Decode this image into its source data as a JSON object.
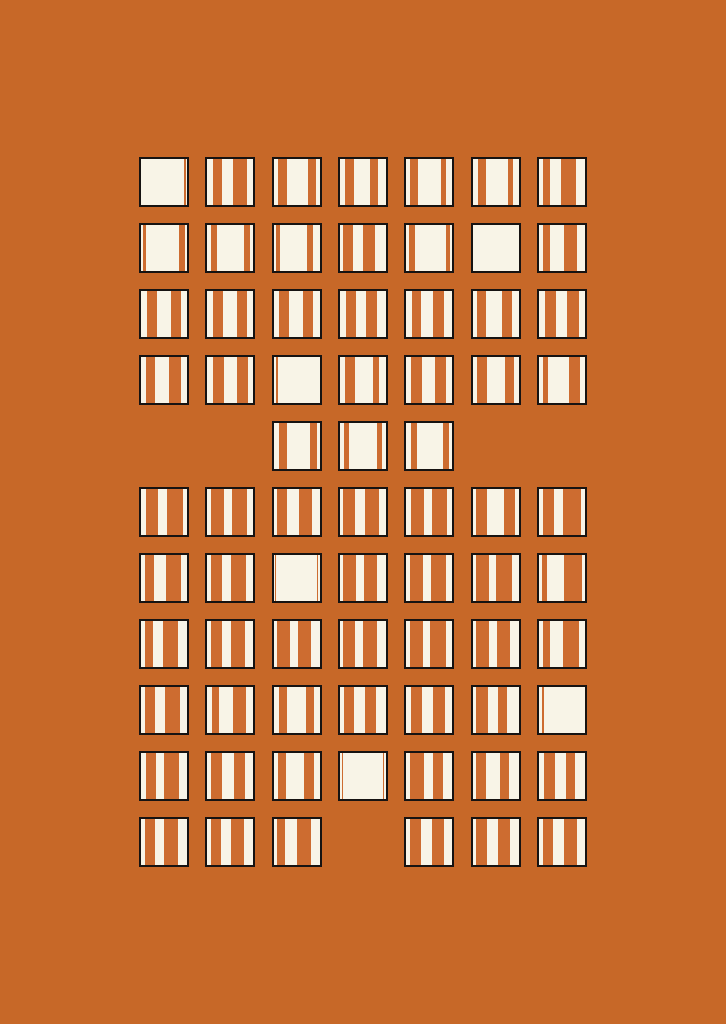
{
  "artwork": {
    "title": "striped-squares-grid-poster",
    "colors": {
      "background": "#C76828",
      "square_fill": "#F8F4E7",
      "stripe": "#CD6C30",
      "border": "#161312"
    },
    "grid": {
      "cols": 7,
      "rows": 11,
      "origin_x": 139,
      "origin_y": 157,
      "pitch_x": 66.33,
      "pitch_y": 66,
      "cell_size": 50,
      "border_px": 2
    },
    "missing_cells_note": "row 4 (0-based) only has cols 2-4; row 10 is missing col 3",
    "cells": [
      {
        "row": 0,
        "col": 0,
        "stripes": [
          [
            93,
            4
          ]
        ]
      },
      {
        "row": 0,
        "col": 1,
        "stripes": [
          [
            13,
            20
          ],
          [
            56,
            30
          ]
        ]
      },
      {
        "row": 0,
        "col": 2,
        "stripes": [
          [
            10,
            20
          ],
          [
            75,
            17
          ]
        ]
      },
      {
        "row": 0,
        "col": 3,
        "stripes": [
          [
            10,
            21
          ],
          [
            66,
            17
          ]
        ]
      },
      {
        "row": 0,
        "col": 4,
        "stripes": [
          [
            8,
            18
          ],
          [
            76,
            10
          ]
        ]
      },
      {
        "row": 0,
        "col": 5,
        "stripes": [
          [
            11,
            18
          ],
          [
            77,
            10
          ]
        ]
      },
      {
        "row": 0,
        "col": 6,
        "stripes": [
          [
            8,
            17
          ],
          [
            48,
            33
          ]
        ]
      },
      {
        "row": 1,
        "col": 0,
        "stripes": [
          [
            4,
            7
          ],
          [
            83,
            12
          ]
        ]
      },
      {
        "row": 1,
        "col": 1,
        "stripes": [
          [
            8,
            13
          ],
          [
            79,
            13
          ]
        ]
      },
      {
        "row": 1,
        "col": 2,
        "stripes": [
          [
            6,
            8
          ],
          [
            72,
            13
          ]
        ]
      },
      {
        "row": 1,
        "col": 3,
        "stripes": [
          [
            6,
            22
          ],
          [
            50,
            26
          ]
        ]
      },
      {
        "row": 1,
        "col": 4,
        "stripes": [
          [
            6,
            12
          ],
          [
            87,
            7
          ]
        ]
      },
      {
        "row": 1,
        "col": 5,
        "stripes": []
      },
      {
        "row": 1,
        "col": 6,
        "stripes": [
          [
            8,
            15
          ],
          [
            54,
            28
          ]
        ]
      },
      {
        "row": 2,
        "col": 0,
        "stripes": [
          [
            14,
            21
          ],
          [
            66,
            22
          ]
        ]
      },
      {
        "row": 2,
        "col": 1,
        "stripes": [
          [
            13,
            22
          ],
          [
            64,
            23
          ]
        ]
      },
      {
        "row": 2,
        "col": 2,
        "stripes": [
          [
            11,
            23
          ],
          [
            63,
            22
          ]
        ]
      },
      {
        "row": 2,
        "col": 3,
        "stripes": [
          [
            12,
            22
          ],
          [
            56,
            24
          ]
        ]
      },
      {
        "row": 2,
        "col": 4,
        "stripes": [
          [
            12,
            20
          ],
          [
            58,
            24
          ]
        ]
      },
      {
        "row": 2,
        "col": 5,
        "stripes": [
          [
            10,
            20
          ],
          [
            64,
            22
          ]
        ]
      },
      {
        "row": 2,
        "col": 6,
        "stripes": [
          [
            14,
            22
          ],
          [
            60,
            26
          ]
        ]
      },
      {
        "row": 3,
        "col": 0,
        "stripes": [
          [
            10,
            20
          ],
          [
            60,
            26
          ]
        ]
      },
      {
        "row": 3,
        "col": 1,
        "stripes": [
          [
            12,
            24
          ],
          [
            64,
            24
          ]
        ]
      },
      {
        "row": 3,
        "col": 2,
        "stripes": [
          [
            5,
            4
          ]
        ]
      },
      {
        "row": 3,
        "col": 3,
        "stripes": [
          [
            10,
            22
          ],
          [
            72,
            12
          ]
        ]
      },
      {
        "row": 3,
        "col": 4,
        "stripes": [
          [
            10,
            24
          ],
          [
            62,
            24
          ]
        ]
      },
      {
        "row": 3,
        "col": 5,
        "stripes": [
          [
            10,
            22
          ],
          [
            71,
            19
          ]
        ]
      },
      {
        "row": 3,
        "col": 6,
        "stripes": [
          [
            9,
            10
          ],
          [
            66,
            24
          ]
        ]
      },
      {
        "row": 4,
        "col": 2,
        "stripes": [
          [
            11,
            19
          ],
          [
            78,
            16
          ]
        ]
      },
      {
        "row": 4,
        "col": 3,
        "stripes": [
          [
            8,
            12
          ],
          [
            80,
            11
          ]
        ]
      },
      {
        "row": 4,
        "col": 4,
        "stripes": [
          [
            11,
            13
          ],
          [
            79,
            14
          ]
        ]
      },
      {
        "row": 5,
        "col": 0,
        "stripes": [
          [
            10,
            28
          ],
          [
            56,
            36
          ]
        ]
      },
      {
        "row": 5,
        "col": 1,
        "stripes": [
          [
            9,
            28
          ],
          [
            54,
            33
          ]
        ]
      },
      {
        "row": 5,
        "col": 2,
        "stripes": [
          [
            7,
            22
          ],
          [
            55,
            28
          ]
        ]
      },
      {
        "row": 5,
        "col": 3,
        "stripes": [
          [
            7,
            25
          ],
          [
            55,
            30
          ]
        ]
      },
      {
        "row": 5,
        "col": 4,
        "stripes": [
          [
            10,
            28
          ],
          [
            56,
            32
          ]
        ]
      },
      {
        "row": 5,
        "col": 5,
        "stripes": [
          [
            7,
            25
          ],
          [
            68,
            25
          ]
        ]
      },
      {
        "row": 5,
        "col": 6,
        "stripes": [
          [
            8,
            24
          ],
          [
            52,
            40
          ]
        ]
      },
      {
        "row": 6,
        "col": 0,
        "stripes": [
          [
            8,
            20
          ],
          [
            54,
            34
          ]
        ]
      },
      {
        "row": 6,
        "col": 1,
        "stripes": [
          [
            8,
            24
          ],
          [
            52,
            33
          ]
        ]
      },
      {
        "row": 6,
        "col": 2,
        "stripes": [
          [
            3,
            3
          ],
          [
            94,
            3
          ]
        ]
      },
      {
        "row": 6,
        "col": 3,
        "stripes": [
          [
            6,
            28
          ],
          [
            52,
            28
          ]
        ]
      },
      {
        "row": 6,
        "col": 4,
        "stripes": [
          [
            7,
            30
          ],
          [
            53,
            34
          ]
        ]
      },
      {
        "row": 6,
        "col": 5,
        "stripes": [
          [
            7,
            28
          ],
          [
            50,
            36
          ]
        ]
      },
      {
        "row": 6,
        "col": 6,
        "stripes": [
          [
            6,
            12
          ],
          [
            55,
            38
          ]
        ]
      },
      {
        "row": 7,
        "col": 0,
        "stripes": [
          [
            8,
            18
          ],
          [
            48,
            32
          ]
        ]
      },
      {
        "row": 7,
        "col": 1,
        "stripes": [
          [
            7,
            25
          ],
          [
            52,
            30
          ]
        ]
      },
      {
        "row": 7,
        "col": 2,
        "stripes": [
          [
            8,
            28
          ],
          [
            54,
            28
          ]
        ]
      },
      {
        "row": 7,
        "col": 3,
        "stripes": [
          [
            7,
            25
          ],
          [
            50,
            30
          ]
        ]
      },
      {
        "row": 7,
        "col": 4,
        "stripes": [
          [
            8,
            28
          ],
          [
            52,
            34
          ]
        ]
      },
      {
        "row": 7,
        "col": 5,
        "stripes": [
          [
            7,
            28
          ],
          [
            52,
            30
          ]
        ]
      },
      {
        "row": 7,
        "col": 6,
        "stripes": [
          [
            8,
            16
          ],
          [
            52,
            36
          ]
        ]
      },
      {
        "row": 8,
        "col": 0,
        "stripes": [
          [
            8,
            22
          ],
          [
            52,
            32
          ]
        ]
      },
      {
        "row": 8,
        "col": 1,
        "stripes": [
          [
            10,
            15
          ],
          [
            55,
            29
          ]
        ]
      },
      {
        "row": 8,
        "col": 2,
        "stripes": [
          [
            11,
            19
          ],
          [
            70,
            18
          ]
        ]
      },
      {
        "row": 8,
        "col": 3,
        "stripes": [
          [
            8,
            22
          ],
          [
            55,
            24
          ]
        ]
      },
      {
        "row": 8,
        "col": 4,
        "stripes": [
          [
            10,
            25
          ],
          [
            58,
            26
          ]
        ]
      },
      {
        "row": 8,
        "col": 5,
        "stripes": [
          [
            8,
            26
          ],
          [
            56,
            19
          ]
        ]
      },
      {
        "row": 8,
        "col": 6,
        "stripes": [
          [
            7,
            4
          ]
        ]
      },
      {
        "row": 9,
        "col": 0,
        "stripes": [
          [
            10,
            22
          ],
          [
            50,
            32
          ]
        ]
      },
      {
        "row": 9,
        "col": 1,
        "stripes": [
          [
            8,
            24
          ],
          [
            57,
            25
          ]
        ]
      },
      {
        "row": 9,
        "col": 2,
        "stripes": [
          [
            10,
            17
          ],
          [
            65,
            22
          ]
        ]
      },
      {
        "row": 9,
        "col": 3,
        "stripes": [
          [
            4,
            3
          ],
          [
            93,
            3
          ]
        ]
      },
      {
        "row": 9,
        "col": 4,
        "stripes": [
          [
            8,
            30
          ],
          [
            58,
            22
          ]
        ]
      },
      {
        "row": 9,
        "col": 5,
        "stripes": [
          [
            8,
            22
          ],
          [
            59,
            21
          ]
        ]
      },
      {
        "row": 9,
        "col": 6,
        "stripes": [
          [
            10,
            25
          ],
          [
            58,
            21
          ]
        ]
      },
      {
        "row": 10,
        "col": 0,
        "stripes": [
          [
            8,
            22
          ],
          [
            50,
            30
          ]
        ]
      },
      {
        "row": 10,
        "col": 1,
        "stripes": [
          [
            8,
            22
          ],
          [
            52,
            28
          ]
        ]
      },
      {
        "row": 10,
        "col": 2,
        "stripes": [
          [
            8,
            16
          ],
          [
            50,
            32
          ]
        ]
      },
      {
        "row": 10,
        "col": 4,
        "stripes": [
          [
            8,
            24
          ],
          [
            55,
            28
          ]
        ]
      },
      {
        "row": 10,
        "col": 5,
        "stripes": [
          [
            8,
            24
          ],
          [
            56,
            26
          ]
        ]
      },
      {
        "row": 10,
        "col": 6,
        "stripes": [
          [
            8,
            22
          ],
          [
            54,
            28
          ]
        ]
      }
    ]
  }
}
